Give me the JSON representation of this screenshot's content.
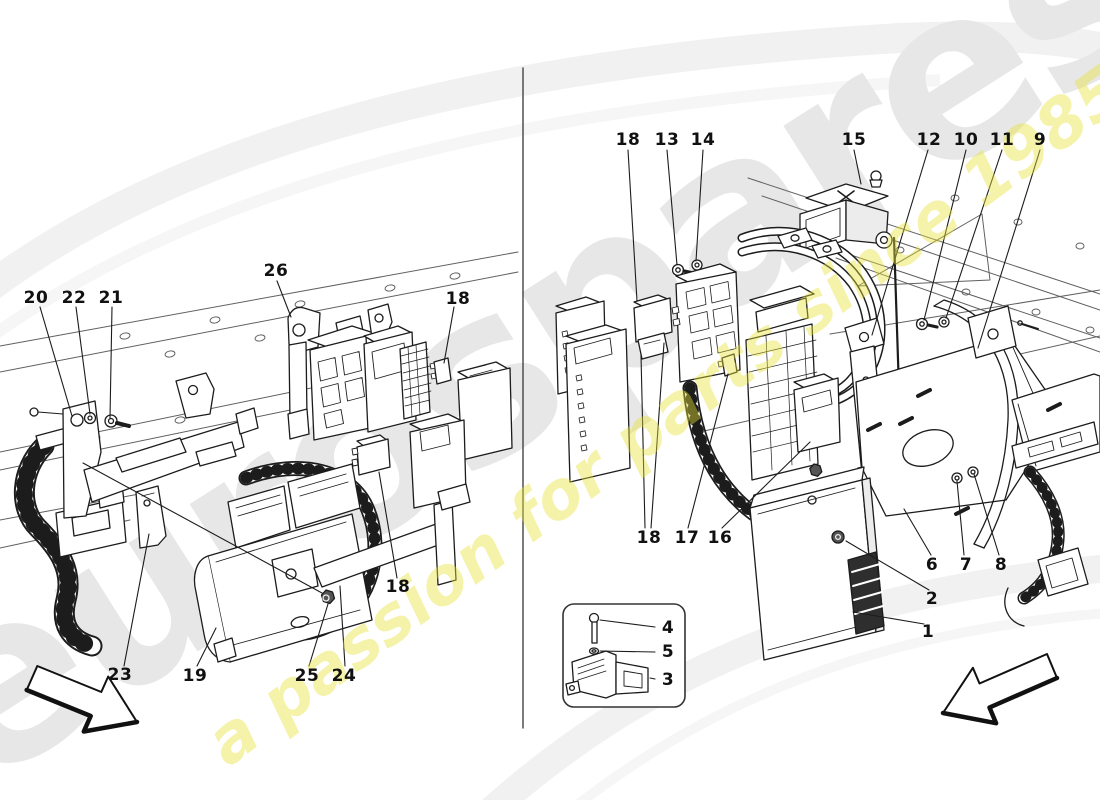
{
  "watermark": {
    "brand_text": "eurospares",
    "tagline_text": "a passion for parts since 1985",
    "brand_color": "#e7e7e7",
    "tagline_color": "#e8e136"
  },
  "diagram": {
    "type": "exploded-parts-diagram",
    "line_color": "#1c1c1c",
    "views": [
      "left-compartment-view",
      "right-compartment-view",
      "sensor-inset"
    ]
  },
  "part_labels": [
    {
      "view": "left",
      "text": "20",
      "x": 36,
      "y": 298
    },
    {
      "view": "left",
      "text": "22",
      "x": 74,
      "y": 298
    },
    {
      "view": "left",
      "text": "21",
      "x": 111,
      "y": 298
    },
    {
      "view": "left",
      "text": "26",
      "x": 276,
      "y": 271
    },
    {
      "view": "left",
      "text": "18",
      "x": 458,
      "y": 299
    },
    {
      "view": "left",
      "text": "23",
      "x": 120,
      "y": 675
    },
    {
      "view": "left",
      "text": "19",
      "x": 195,
      "y": 676
    },
    {
      "view": "left",
      "text": "25",
      "x": 307,
      "y": 676
    },
    {
      "view": "left",
      "text": "24",
      "x": 344,
      "y": 676
    },
    {
      "view": "left",
      "text": "18",
      "x": 398,
      "y": 587
    },
    {
      "view": "right",
      "text": "18",
      "x": 628,
      "y": 140
    },
    {
      "view": "right",
      "text": "13",
      "x": 667,
      "y": 140
    },
    {
      "view": "right",
      "text": "14",
      "x": 703,
      "y": 140
    },
    {
      "view": "right",
      "text": "15",
      "x": 854,
      "y": 140
    },
    {
      "view": "right",
      "text": "12",
      "x": 929,
      "y": 140
    },
    {
      "view": "right",
      "text": "10",
      "x": 966,
      "y": 140
    },
    {
      "view": "right",
      "text": "11",
      "x": 1002,
      "y": 140
    },
    {
      "view": "right",
      "text": "9",
      "x": 1040,
      "y": 140
    },
    {
      "view": "right",
      "text": "18",
      "x": 649,
      "y": 538
    },
    {
      "view": "right",
      "text": "17",
      "x": 687,
      "y": 538
    },
    {
      "view": "right",
      "text": "16",
      "x": 720,
      "y": 538
    },
    {
      "view": "right",
      "text": "6",
      "x": 932,
      "y": 565
    },
    {
      "view": "right",
      "text": "7",
      "x": 966,
      "y": 565
    },
    {
      "view": "right",
      "text": "8",
      "x": 1001,
      "y": 565
    },
    {
      "view": "right",
      "text": "2",
      "x": 932,
      "y": 599
    },
    {
      "view": "right",
      "text": "1",
      "x": 928,
      "y": 632
    },
    {
      "view": "inset",
      "text": "4",
      "x": 668,
      "y": 628
    },
    {
      "view": "inset",
      "text": "5",
      "x": 668,
      "y": 652
    },
    {
      "view": "inset",
      "text": "3",
      "x": 668,
      "y": 680
    }
  ]
}
